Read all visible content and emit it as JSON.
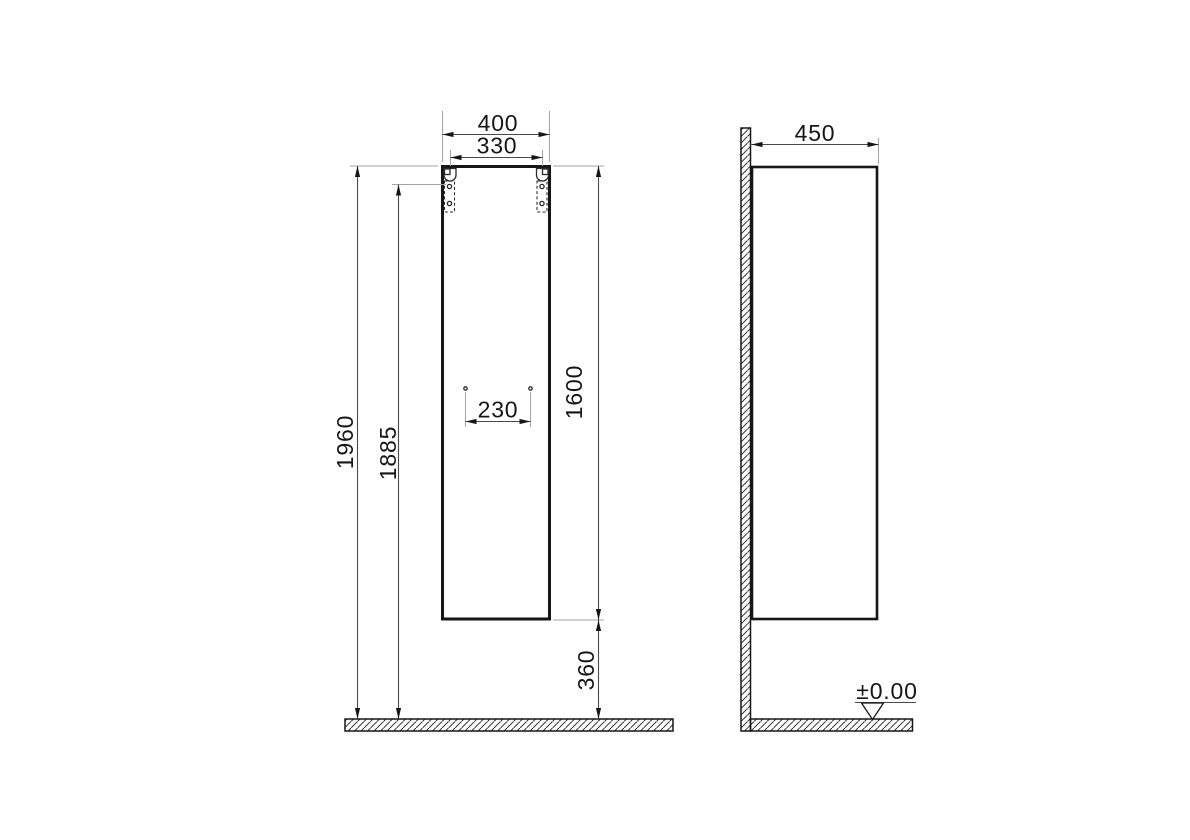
{
  "drawing": {
    "front_view": {
      "overall_width": "400",
      "bracket_spacing": "330",
      "hole_spacing": "230",
      "overall_height": "1960",
      "bracket_height": "1885",
      "cabinet_height": "1600",
      "floor_clearance": "360"
    },
    "side_view": {
      "depth": "450",
      "floor_level": "±0.00"
    },
    "colors": {
      "background": "#ffffff",
      "outline": "#161616",
      "dimension_line": "#4a4a4a",
      "extension_line": "#a3a3a3"
    }
  }
}
